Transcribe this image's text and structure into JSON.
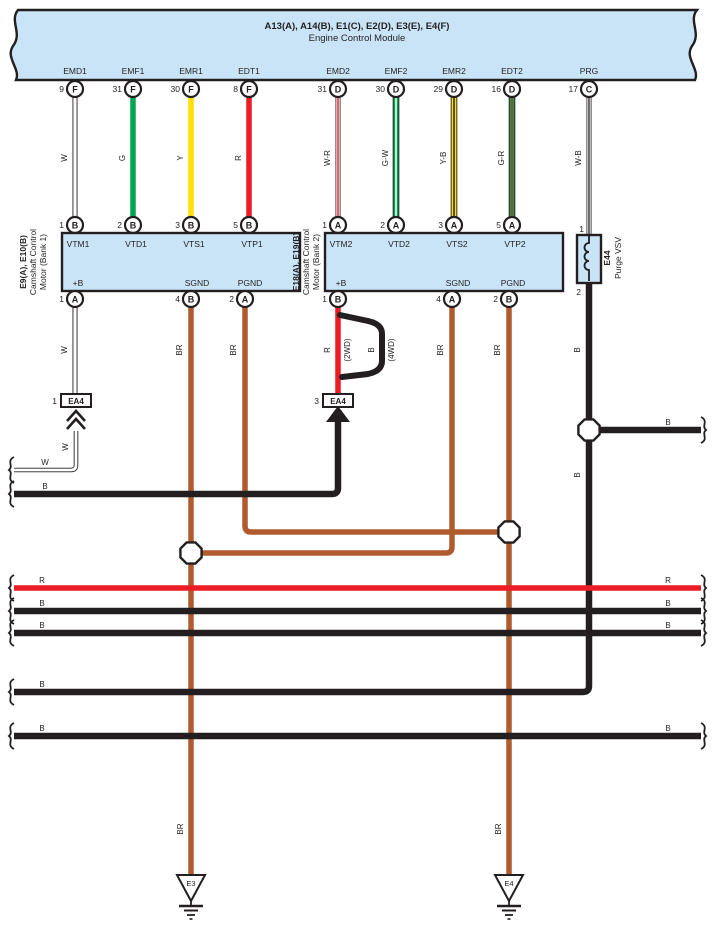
{
  "colors": {
    "panel": "#C9E4F7",
    "outline": "#231F20",
    "green": "#00A651",
    "yellow": "#FFE000",
    "red": "#EC1C24",
    "brown": "#B05B2E",
    "white": "#FFFFFF"
  },
  "ecm": {
    "title": "A13(A), A14(B), E1(C), E2(D), E3(E), E4(F)",
    "subtitle": "Engine Control Module",
    "pins": [
      {
        "signal": "EMD1",
        "num": "9",
        "conn": "F"
      },
      {
        "signal": "EMF1",
        "num": "31",
        "conn": "F"
      },
      {
        "signal": "EMR1",
        "num": "30",
        "conn": "F"
      },
      {
        "signal": "EDT1",
        "num": "8",
        "conn": "F"
      },
      {
        "signal": "EMD2",
        "num": "31",
        "conn": "D"
      },
      {
        "signal": "EMF2",
        "num": "30",
        "conn": "D"
      },
      {
        "signal": "EMR2",
        "num": "29",
        "conn": "D"
      },
      {
        "signal": "EDT2",
        "num": "16",
        "conn": "D"
      },
      {
        "signal": "PRG",
        "num": "17",
        "conn": "C"
      }
    ],
    "wire_colors": [
      "W",
      "G",
      "Y",
      "R",
      "W-R",
      "G-W",
      "Y-B",
      "G-R",
      "W-B"
    ]
  },
  "bank1": {
    "code": "E9(A), E10(B)",
    "desc1": "Camshaft Control",
    "desc2": "Motor (Bank 1)",
    "top_pins": [
      {
        "num": "1",
        "conn": "B",
        "signal": "VTM1"
      },
      {
        "num": "2",
        "conn": "B",
        "signal": "VTD1"
      },
      {
        "num": "3",
        "conn": "B",
        "signal": "VTS1"
      },
      {
        "num": "5",
        "conn": "B",
        "signal": "VTP1"
      }
    ],
    "bottom_pins": [
      {
        "num": "1",
        "conn": "A",
        "signal": "+B"
      },
      {
        "num": "4",
        "conn": "B",
        "signal": "SGND"
      },
      {
        "num": "2",
        "conn": "A",
        "signal": "PGND"
      }
    ]
  },
  "bank2": {
    "code": "E18(A), E19(B)",
    "desc1": "Camshaft Control",
    "desc2": "Motor (Bank 2)",
    "top_pins": [
      {
        "num": "1",
        "conn": "A",
        "signal": "VTM2"
      },
      {
        "num": "2",
        "conn": "A",
        "signal": "VTD2"
      },
      {
        "num": "3",
        "conn": "A",
        "signal": "VTS2"
      },
      {
        "num": "5",
        "conn": "A",
        "signal": "VTP2"
      }
    ],
    "bottom_pins": [
      {
        "num": "1",
        "conn": "B",
        "signal": "+B"
      },
      {
        "num": "4",
        "conn": "A",
        "signal": "SGND"
      },
      {
        "num": "2",
        "conn": "B",
        "signal": "PGND"
      }
    ]
  },
  "vsv": {
    "code": "E44",
    "name": "Purge VSV",
    "pin_top": "1",
    "pin_bottom": "2"
  },
  "connectors": {
    "ea4_1": {
      "num": "1",
      "label": "EA4"
    },
    "ea4_3": {
      "num": "3",
      "label": "EA4"
    }
  },
  "labels": {
    "w": "W",
    "g": "G",
    "y": "Y",
    "r": "R",
    "wr": "W-R",
    "gw": "G-W",
    "yb": "Y-B",
    "gr": "G-R",
    "wb": "W-B",
    "b": "B",
    "br": "BR",
    "twd": "(2WD)",
    "fwd": "(4WD)"
  },
  "grounds": [
    {
      "label": "E3"
    },
    {
      "label": "E4"
    }
  ]
}
